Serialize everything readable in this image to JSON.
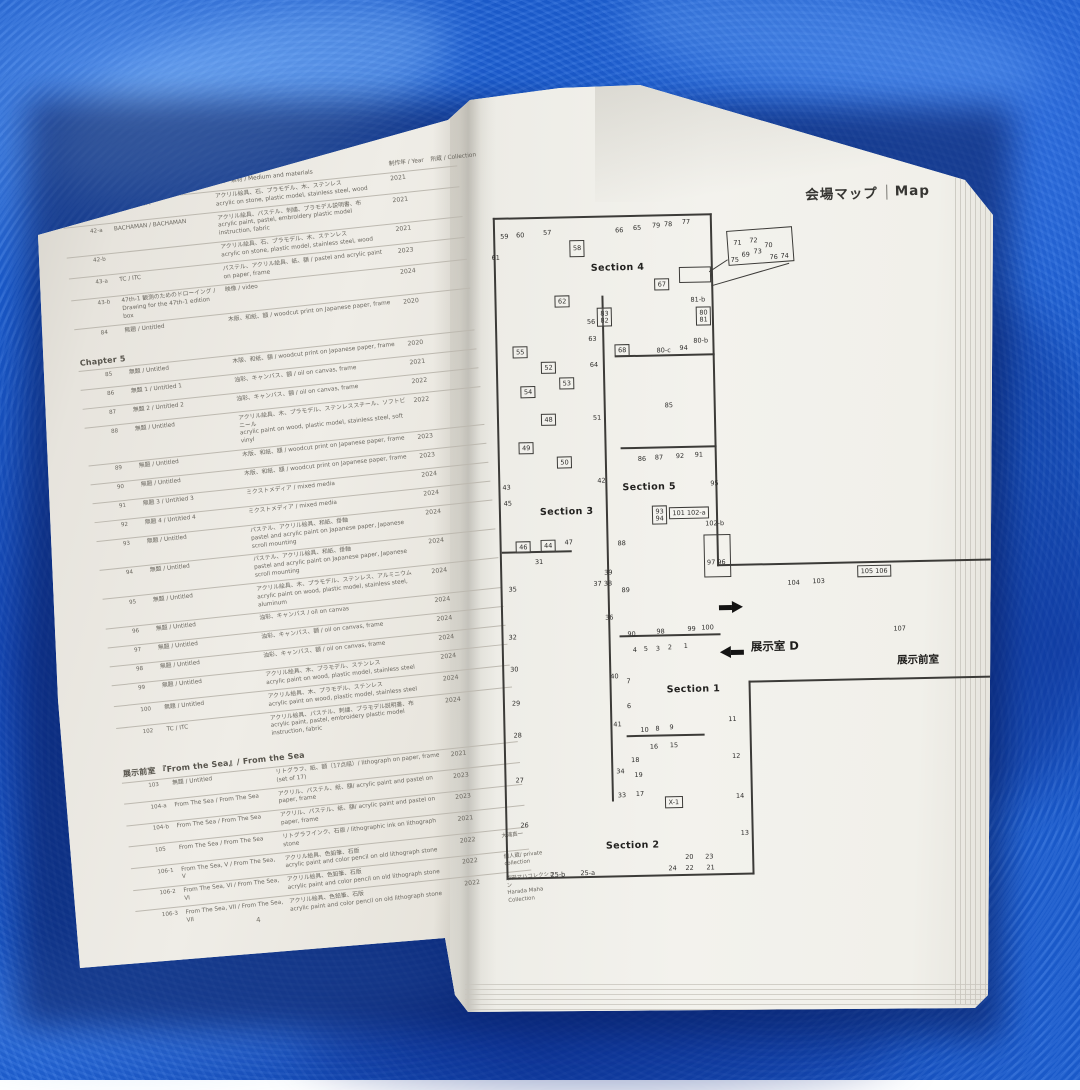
{
  "scene": {
    "towel_color": "#1c60d4",
    "page_color_left": "#e7e4dd",
    "page_color_right": "#f2f1ec",
    "ink_color": "#3c3b38"
  },
  "left_page": {
    "page_number": "4",
    "header": {
      "medium": "技法・素材 / Medium and materials",
      "year": "制作年 / Year",
      "collection": "所蔵 / Collection"
    },
    "rows": [
      {
        "no": "41",
        "title": "NADA / NADA",
        "m1": "アクリル絵具、石、プラモデル、木、ステンレス",
        "m2": "acrylic on stone, plastic model, stainless steel, wood",
        "year": "2021"
      },
      {
        "no": "42-a",
        "title": "BACHAMAN / BACHAMAN",
        "m1": "アクリル絵具、パステル、刺繍、プラモデル説明書、布",
        "m2": "acrylic paint, pastel, embroidery  plastic model instruction, fabric",
        "year": "2021"
      },
      {
        "no": "42-b",
        "title": "",
        "m1": "アクリル絵具、石、プラモデル、木、ステンレス",
        "m2": "acrylic on stone, plastic model, stainless steel, wood",
        "year": "2021"
      },
      {
        "no": "43-a",
        "title": "TC / ITC",
        "m1": "パステル、アクリル絵具、紙、額 / pastel and acrylic paint on paper, frame",
        "year": "2023"
      },
      {
        "no": "43-b",
        "title": "47th-1 観測のためのドローイング / Drawing for the 47th-1 edition box",
        "m1": "映像 / video",
        "year": "2024"
      },
      {
        "no": "84",
        "title": "無題 / Untitled",
        "m1": "木版、和紙、額 / woodcut print on Japanese paper, frame",
        "year": "2020"
      },
      {
        "section": "Chapter 5"
      },
      {
        "no": "85",
        "title": "無題 / Untitled",
        "m1": "木版、和紙、額 / woodcut print on Japanese paper, frame",
        "year": "2020"
      },
      {
        "no": "86",
        "title": "無題 1 / Untitled 1",
        "m1": "油彩、キャンバス、額 / oil on canvas, frame",
        "year": "2021"
      },
      {
        "no": "87",
        "title": "無題 2 / Untitled 2",
        "m1": "油彩、キャンバス、額 / oil on canvas, frame",
        "year": "2022"
      },
      {
        "no": "88",
        "title": "無題 / Untitled",
        "m1": "アクリル絵具、木、プラモデル、ステンレススチール、ソフトビニール",
        "m2": "acrylic paint on wood, plastic model, stainless steel, soft vinyl",
        "year": "2022"
      },
      {
        "no": "89",
        "title": "無題 / Untitled",
        "m1": "木版、和紙、額 / woodcut print on Japanese paper, frame",
        "year": "2023"
      },
      {
        "no": "90",
        "title": "無題 / Untitled",
        "m1": "木版、和紙、額 / woodcut print on Japanese paper, frame",
        "year": "2023"
      },
      {
        "no": "91",
        "title": "無題 3 / Untitled 3",
        "m1": "ミクストメディア / mixed media",
        "year": "2024"
      },
      {
        "no": "92",
        "title": "無題 4 / Untitled 4",
        "m1": "ミクストメディア / mixed media",
        "year": "2024"
      },
      {
        "no": "93",
        "title": "無題 / Untitled",
        "m1": "パステル、アクリル絵具、和紙、掛軸",
        "m2": "pastel and acrylic paint on Japanese paper, Japanese scroll mounting",
        "year": "2024"
      },
      {
        "no": "94",
        "title": "無題 / Untitled",
        "m1": "パステル、アクリル絵具、和紙、掛軸",
        "m2": "pastel and acrylic paint on Japanese paper, Japanese scroll mounting",
        "year": "2024"
      },
      {
        "no": "95",
        "title": "無題 / Untitled",
        "m1": "アクリル絵具、木、プラモデル、ステンレス、アルミニウム",
        "m2": "acrylic paint on wood,  plastic model, stainless steel, aluminum",
        "year": "2024"
      },
      {
        "no": "96",
        "title": "無題 / Untitled",
        "m1": "油彩、キャンバス / oil on canvas",
        "year": "2024"
      },
      {
        "no": "97",
        "title": "無題 / Untitled",
        "m1": "油彩、キャンバス、額 / oil on canvas, frame",
        "year": "2024"
      },
      {
        "no": "98",
        "title": "無題 / Untitled",
        "m1": "油彩、キャンバス、額 / oil on canvas, frame",
        "year": "2024"
      },
      {
        "no": "99",
        "title": "無題 / Untitled",
        "m1": "アクリル絵具、木、プラモデル、ステンレス",
        "m2": "acrylic paint on wood, plastic model, stainless steel",
        "year": "2024"
      },
      {
        "no": "100",
        "title": "無題 / Untitled",
        "m1": "アクリル絵具、木、プラモデル、ステンレス",
        "m2": "acrylic paint on wood, plastic model, stainless steel",
        "year": "2024"
      },
      {
        "no": "102",
        "title": "TC / ITC",
        "m1": "アクリル絵具、パステル、刺繍、プラモデル説明書、布",
        "m2": "acrylic paint, pastel, embroidery  plastic model instruction, fabric",
        "year": "2024"
      },
      {
        "section": "展示前室 『From the Sea』/ From the Sea"
      },
      {
        "no": "103",
        "title": "無題 / Untitled",
        "m1": "リトグラフ、紙、額（17点組）/ lithograph on paper, frame (set of 17)",
        "year": "2021"
      },
      {
        "no": "104-a",
        "title": "From The Sea / From The Sea",
        "m1": "アクリル、パステル、紙、額/ acrylic paint and pastel on paper, frame",
        "year": "2023"
      },
      {
        "no": "104-b",
        "title": "From The Sea / From The Sea",
        "m1": "アクリル、パステル、紙、額/ acrylic paint and pastel on paper, frame",
        "year": "2023"
      },
      {
        "no": "105",
        "title": "From The Sea / From The Sea",
        "m1": "リトグラフインク、石版 / lithographic ink on  lithograph stone",
        "year": "2021"
      },
      {
        "no": "106-1",
        "title": "From The Sea, V / From The Sea, V",
        "m1": "アクリル絵具、色鉛筆、石版",
        "m2": "acrylic paint and color pencil on old lithograph stone",
        "year": "2022",
        "col": "大浦真一"
      },
      {
        "no": "106-2",
        "title": "From The Sea, VI / From The Sea, VI",
        "m1": "アクリル絵具、色鉛筆、石版",
        "m2": "acrylic paint and color pencil on old lithograph stone",
        "year": "2022",
        "col": "個人蔵/ private collection"
      },
      {
        "no": "106-3",
        "title": "From The Sea, VII / From The Sea, VII",
        "m1": "アクリル絵具、色鉛筆、石版",
        "m2": "acrylic paint and color pencil on old lithograph stone",
        "year": "2022",
        "col": "原田マハコレクション",
        "col2": "Harada Maha Collection"
      }
    ]
  },
  "right_page": {
    "title_jp": "会場マップ",
    "title_en": "Map",
    "map": {
      "walls": [
        {
          "x": 3,
          "y": 6,
          "w": 219,
          "h": 1.5
        },
        {
          "x": 3,
          "y": 6,
          "w": 1.5,
          "h": 662
        },
        {
          "x": 3,
          "y": 666,
          "w": 248,
          "h": 1.5
        },
        {
          "x": 220,
          "y": 6,
          "w": 1.5,
          "h": 353
        },
        {
          "x": 249,
          "y": 474,
          "w": 1.5,
          "h": 194
        },
        {
          "x": 220,
          "y": 357,
          "w": 274,
          "h": 1.5
        },
        {
          "x": 249,
          "y": 474,
          "w": 245,
          "h": 1.5
        },
        {
          "x": 110,
          "y": 86,
          "w": 1.5,
          "h": 506
        },
        {
          "x": 122,
          "y": 146,
          "w": 100,
          "h": 1.5
        },
        {
          "x": 126,
          "y": 238,
          "w": 96,
          "h": 1.5
        },
        {
          "x": 121,
          "y": 426,
          "w": 101,
          "h": 1.5
        },
        {
          "x": 126,
          "y": 526,
          "w": 78,
          "h": 1.5
        },
        {
          "x": 5,
          "y": 340,
          "w": 70,
          "h": 1.5
        },
        {
          "x": 218,
          "y": 64,
          "w": 22,
          "h": 1,
          "r": -32
        },
        {
          "x": 220,
          "y": 78,
          "w": 81,
          "h": 1,
          "r": -15
        }
      ],
      "boxes": [
        {
          "x": 188,
          "y": 59,
          "w": 30,
          "h": 14
        },
        {
          "x": 236,
          "y": 24,
          "w": 64,
          "h": 33,
          "r": -3
        },
        {
          "x": 207,
          "y": 327,
          "w": 25,
          "h": 41
        }
      ],
      "labels": [
        {
          "t": "59",
          "x": 10,
          "y": 22
        },
        {
          "t": "60",
          "x": 26,
          "y": 21
        },
        {
          "t": "57",
          "x": 53,
          "y": 19
        },
        {
          "t": "61",
          "x": 1,
          "y": 43
        },
        {
          "t": "66",
          "x": 125,
          "y": 18
        },
        {
          "t": "65",
          "x": 143,
          "y": 16
        },
        {
          "t": "79",
          "x": 162,
          "y": 14
        },
        {
          "t": "78",
          "x": 174,
          "y": 13
        },
        {
          "t": "77",
          "x": 192,
          "y": 11
        },
        {
          "t": "71",
          "x": 243,
          "y": 33
        },
        {
          "t": "72",
          "x": 259,
          "y": 31
        },
        {
          "t": "70",
          "x": 274,
          "y": 36
        },
        {
          "t": "73",
          "x": 263,
          "y": 42
        },
        {
          "t": "69",
          "x": 251,
          "y": 45
        },
        {
          "t": "75",
          "x": 240,
          "y": 50
        },
        {
          "t": "76",
          "x": 279,
          "y": 48
        },
        {
          "t": "74",
          "x": 290,
          "y": 47
        },
        {
          "t": "58",
          "x": 79,
          "y": 30,
          "cls": "box tall"
        },
        {
          "t": "67",
          "x": 163,
          "y": 70,
          "cls": "box"
        },
        {
          "t": "81-b",
          "x": 199,
          "y": 89
        },
        {
          "t": "62",
          "x": 63,
          "y": 85,
          "cls": "box"
        },
        {
          "t": "56",
          "x": 95,
          "y": 109
        },
        {
          "t": "83\n82",
          "x": 105,
          "y": 98,
          "cls": "box"
        },
        {
          "t": "80\n81",
          "x": 204,
          "y": 99,
          "cls": "box"
        },
        {
          "t": "63",
          "x": 96,
          "y": 126
        },
        {
          "t": "80-b",
          "x": 201,
          "y": 130
        },
        {
          "t": "55",
          "x": 20,
          "y": 135,
          "cls": "box"
        },
        {
          "t": "68",
          "x": 122,
          "y": 135,
          "cls": "box"
        },
        {
          "t": "80-c",
          "x": 164,
          "y": 139
        },
        {
          "t": "94",
          "x": 187,
          "y": 137
        },
        {
          "t": "52",
          "x": 48,
          "y": 151,
          "cls": "box"
        },
        {
          "t": "64",
          "x": 97,
          "y": 152
        },
        {
          "t": "53",
          "x": 66,
          "y": 167,
          "cls": "box"
        },
        {
          "t": "54",
          "x": 27,
          "y": 175,
          "cls": "box"
        },
        {
          "t": "85",
          "x": 171,
          "y": 194
        },
        {
          "t": "48",
          "x": 47,
          "y": 203,
          "cls": "box"
        },
        {
          "t": "51",
          "x": 99,
          "y": 205
        },
        {
          "t": "49",
          "x": 24,
          "y": 231,
          "cls": "box"
        },
        {
          "t": "50",
          "x": 62,
          "y": 246,
          "cls": "box"
        },
        {
          "t": "43",
          "x": 7,
          "y": 273
        },
        {
          "t": "45",
          "x": 8,
          "y": 289
        },
        {
          "t": "42",
          "x": 102,
          "y": 268
        },
        {
          "t": "86",
          "x": 143,
          "y": 247
        },
        {
          "t": "87",
          "x": 160,
          "y": 246
        },
        {
          "t": "92",
          "x": 181,
          "y": 245
        },
        {
          "t": "91",
          "x": 200,
          "y": 244
        },
        {
          "t": "95",
          "x": 215,
          "y": 273
        },
        {
          "t": "93\n94",
          "x": 156,
          "y": 297,
          "cls": "box"
        },
        {
          "t": "101 102-a",
          "x": 173,
          "y": 299,
          "cls": "box"
        },
        {
          "t": "102-b",
          "x": 209,
          "y": 313
        },
        {
          "t": "46",
          "x": 19,
          "y": 330,
          "cls": "box"
        },
        {
          "t": "44",
          "x": 44,
          "y": 329,
          "cls": "box"
        },
        {
          "t": "47",
          "x": 68,
          "y": 329
        },
        {
          "t": "31",
          "x": 38,
          "y": 348
        },
        {
          "t": "35",
          "x": 11,
          "y": 375
        },
        {
          "t": "88",
          "x": 121,
          "y": 331
        },
        {
          "t": "39",
          "x": 107,
          "y": 360
        },
        {
          "t": "37 38",
          "x": 96,
          "y": 371
        },
        {
          "t": "89",
          "x": 124,
          "y": 378
        },
        {
          "t": "97 96",
          "x": 210,
          "y": 352
        },
        {
          "t": "104",
          "x": 290,
          "y": 374
        },
        {
          "t": "103",
          "x": 315,
          "y": 373
        },
        {
          "t": "105 106",
          "x": 360,
          "y": 361,
          "cls": "box"
        },
        {
          "t": "107",
          "x": 395,
          "y": 422
        },
        {
          "t": "36",
          "x": 107,
          "y": 405
        },
        {
          "t": "32",
          "x": 10,
          "y": 423
        },
        {
          "t": "30",
          "x": 11,
          "y": 455
        },
        {
          "t": "29",
          "x": 12,
          "y": 489
        },
        {
          "t": "28",
          "x": 13,
          "y": 521
        },
        {
          "t": "90",
          "x": 129,
          "y": 422
        },
        {
          "t": "98",
          "x": 158,
          "y": 420
        },
        {
          "t": "99",
          "x": 189,
          "y": 418
        },
        {
          "t": "100",
          "x": 203,
          "y": 417
        },
        {
          "t": "4",
          "x": 134,
          "y": 438
        },
        {
          "t": "5",
          "x": 145,
          "y": 437
        },
        {
          "t": "3",
          "x": 157,
          "y": 437
        },
        {
          "t": "2",
          "x": 169,
          "y": 436
        },
        {
          "t": "1",
          "x": 185,
          "y": 435
        },
        {
          "t": "40",
          "x": 111,
          "y": 464
        },
        {
          "t": "7",
          "x": 127,
          "y": 469
        },
        {
          "t": "6",
          "x": 127,
          "y": 494
        },
        {
          "t": "41",
          "x": 113,
          "y": 512
        },
        {
          "t": "10",
          "x": 140,
          "y": 518
        },
        {
          "t": "8",
          "x": 155,
          "y": 517
        },
        {
          "t": "9",
          "x": 169,
          "y": 516
        },
        {
          "t": "11",
          "x": 228,
          "y": 509
        },
        {
          "t": "16",
          "x": 149,
          "y": 535
        },
        {
          "t": "15",
          "x": 169,
          "y": 534
        },
        {
          "t": "12",
          "x": 231,
          "y": 546
        },
        {
          "t": "18",
          "x": 130,
          "y": 548
        },
        {
          "t": "34",
          "x": 115,
          "y": 559
        },
        {
          "t": "19",
          "x": 133,
          "y": 563
        },
        {
          "t": "33",
          "x": 116,
          "y": 583
        },
        {
          "t": "17",
          "x": 134,
          "y": 582
        },
        {
          "t": "14",
          "x": 234,
          "y": 586
        },
        {
          "t": "X-1",
          "x": 163,
          "y": 588,
          "cls": "box"
        },
        {
          "t": "13",
          "x": 238,
          "y": 623
        },
        {
          "t": "27",
          "x": 14,
          "y": 566
        },
        {
          "t": "26",
          "x": 18,
          "y": 611
        },
        {
          "t": "20",
          "x": 182,
          "y": 646
        },
        {
          "t": "23",
          "x": 202,
          "y": 646
        },
        {
          "t": "24",
          "x": 165,
          "y": 657
        },
        {
          "t": "22",
          "x": 182,
          "y": 657
        },
        {
          "t": "21",
          "x": 203,
          "y": 657
        },
        {
          "t": "25-b",
          "x": 47,
          "y": 661
        },
        {
          "t": "25-a",
          "x": 77,
          "y": 660
        }
      ],
      "sections": [
        {
          "t": "Section 4",
          "x": 100,
          "y": 53
        },
        {
          "t": "Section 3",
          "x": 44,
          "y": 296
        },
        {
          "t": "Section 5",
          "x": 127,
          "y": 273
        },
        {
          "t": "Section 1",
          "x": 167,
          "y": 476
        },
        {
          "t": "Section 2",
          "x": 103,
          "y": 631
        }
      ],
      "notes": [
        {
          "t": "展示室 D",
          "x": 252,
          "y": 432,
          "s": 11.5
        },
        {
          "t": "展示前室",
          "x": 398,
          "y": 449,
          "s": 10.5
        }
      ],
      "arrows": [
        {
          "dir": "right",
          "x": 221,
          "y": 394
        },
        {
          "dir": "left",
          "x": 221,
          "y": 439
        }
      ]
    }
  }
}
